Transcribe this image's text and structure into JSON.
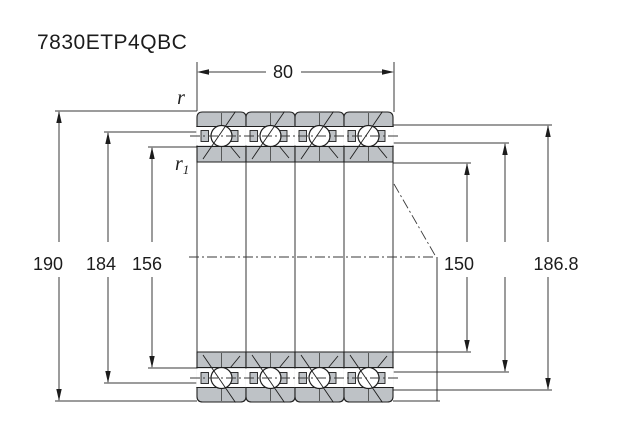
{
  "title": "7830ETP4QBC",
  "dims": {
    "top_width": "80",
    "left": [
      "190",
      "184",
      "156"
    ],
    "bore": "150",
    "od_effective": "186.8",
    "r": "r",
    "r1_base": "r",
    "r1_sub": "1"
  },
  "colors": {
    "ring_fill": "#bec2c6",
    "line": "#1e1e1e",
    "dim_line": "#3a3a3a"
  }
}
